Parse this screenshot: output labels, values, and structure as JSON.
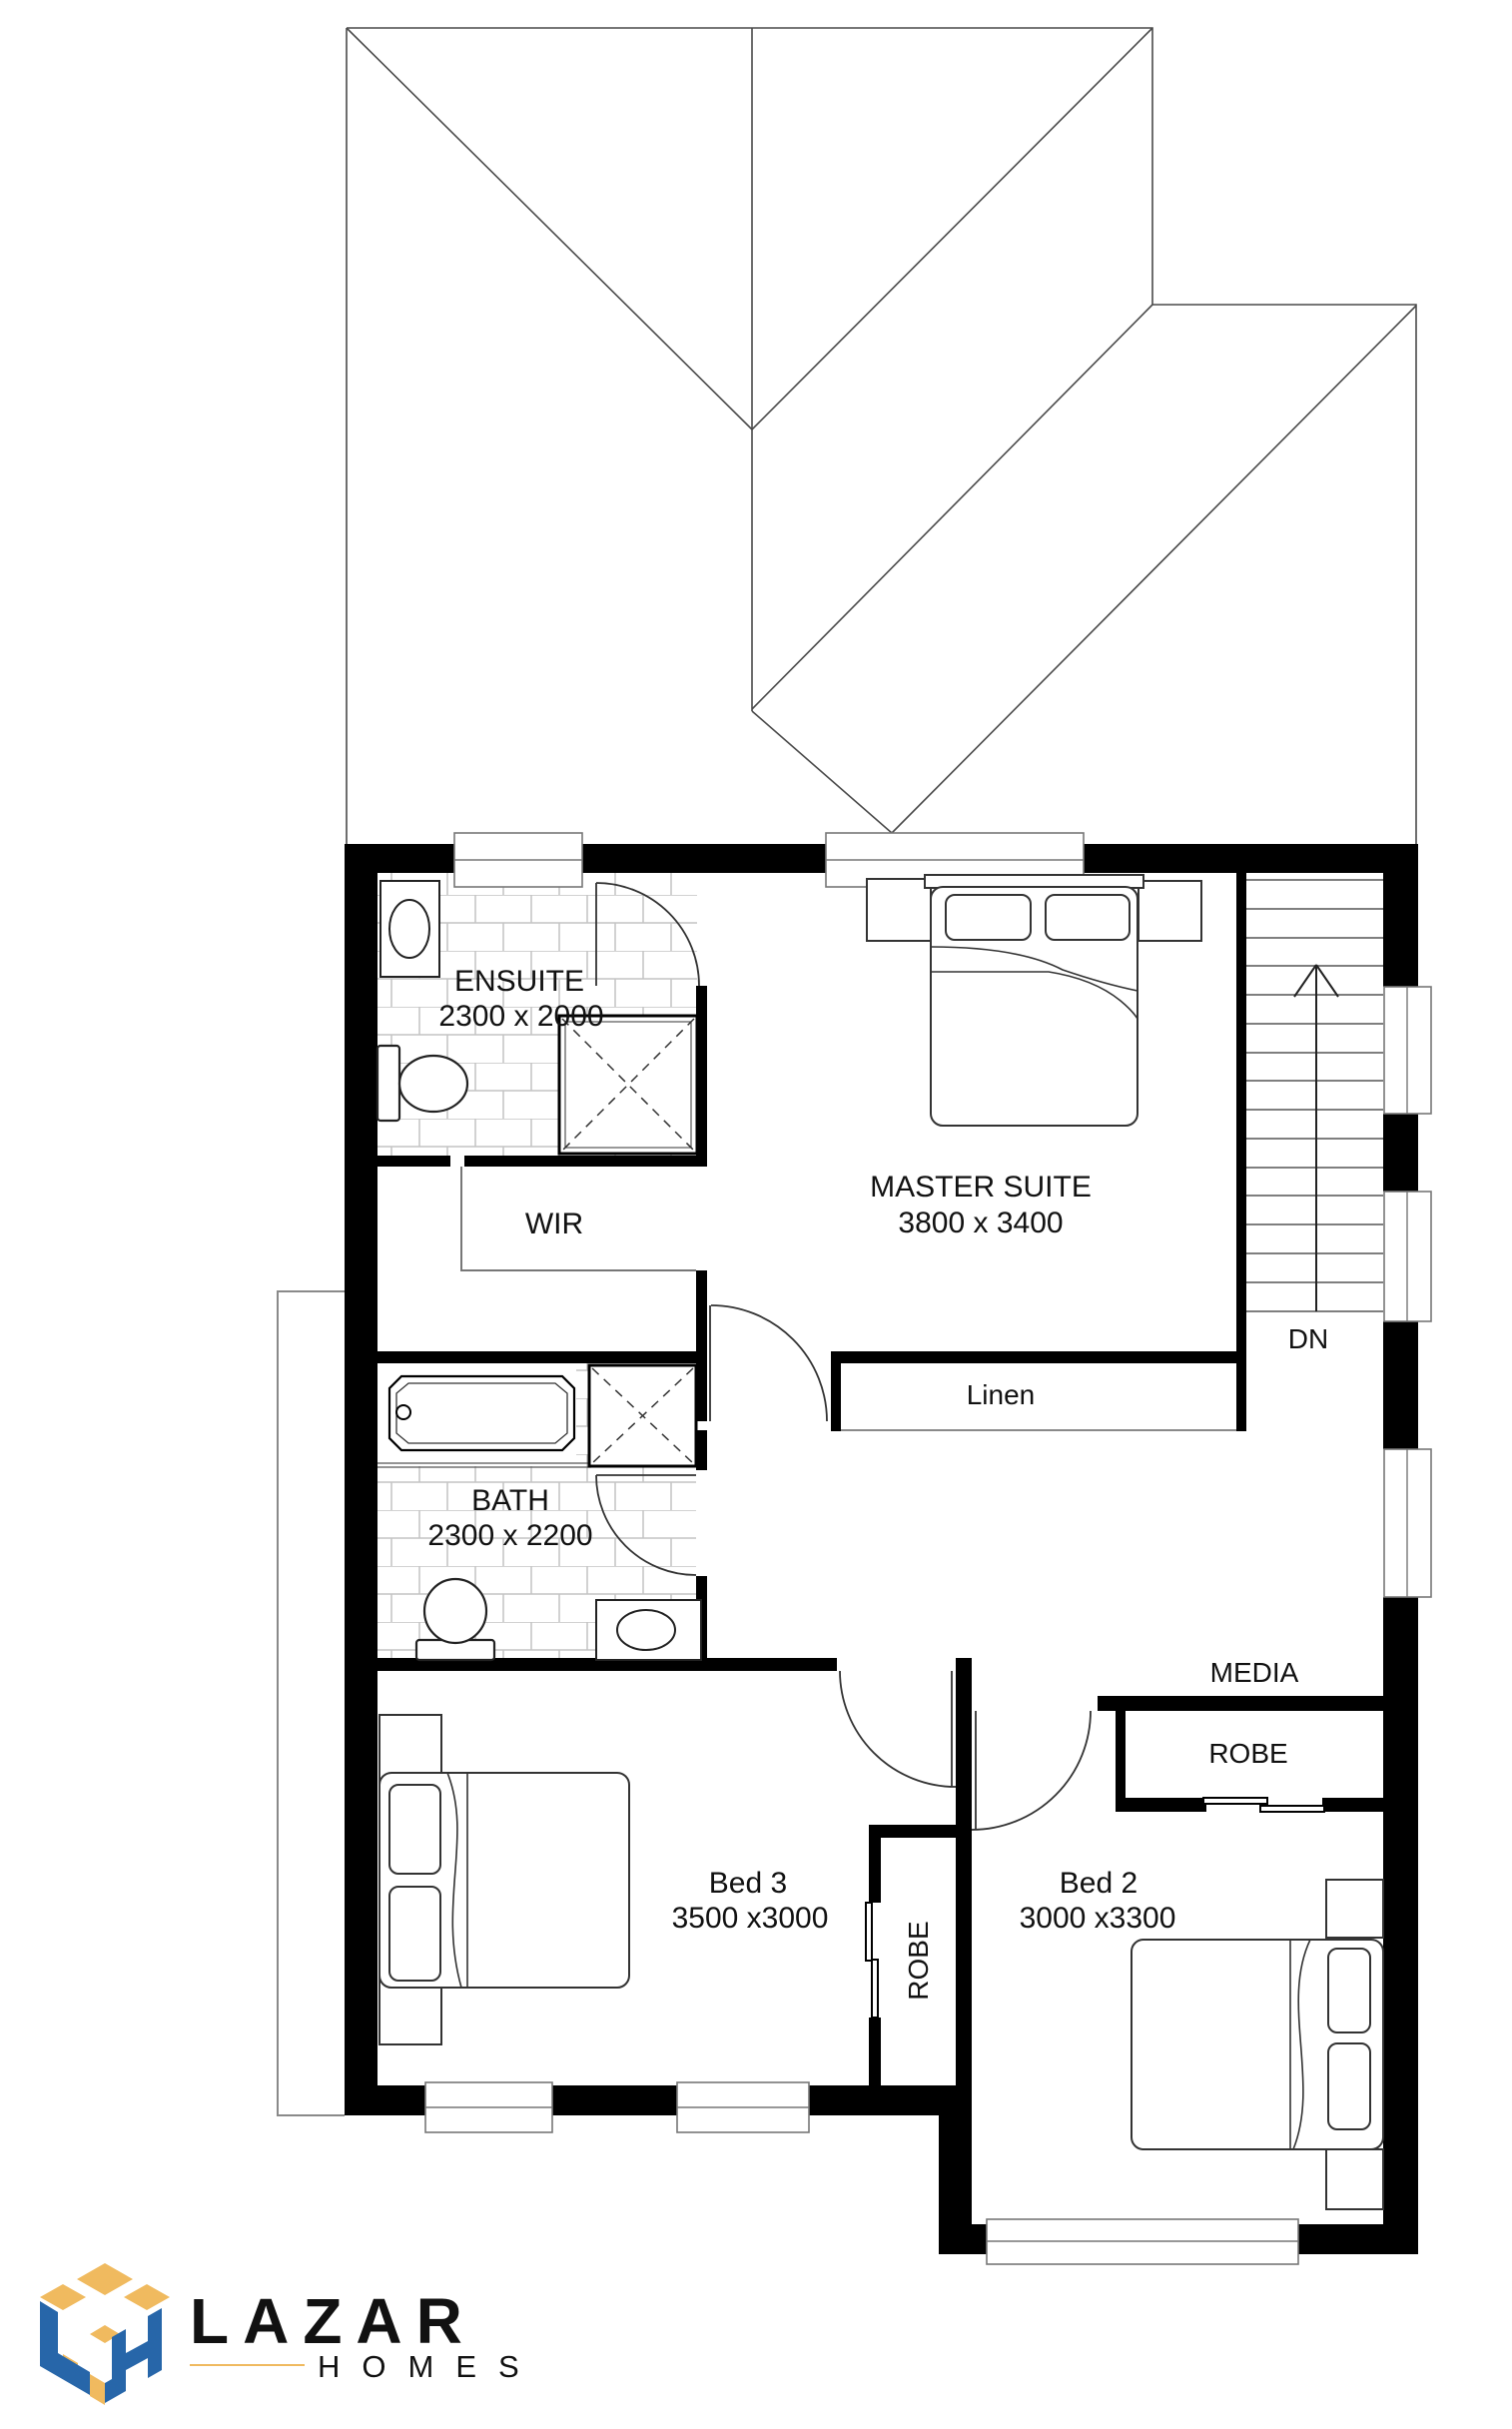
{
  "plan": {
    "rooms": {
      "ensuite": {
        "name": "ENSUITE",
        "dims": "2300 x 2000"
      },
      "master": {
        "name": "MASTER SUITE",
        "dims": "3800 x 3400"
      },
      "wir": {
        "name": "WIR"
      },
      "linen": {
        "name": "Linen"
      },
      "bath": {
        "name": "BATH",
        "dims": "2300 x 2200"
      },
      "media": {
        "name": "MEDIA"
      },
      "robe_bed2": {
        "name": "ROBE"
      },
      "robe_bed3": {
        "name": "ROBE"
      },
      "bed3": {
        "name": "Bed 3",
        "dims": "3500 x3000"
      },
      "bed2": {
        "name": "Bed 2",
        "dims": "3000 x3300"
      }
    },
    "stairs": {
      "direction_label": "DN"
    }
  },
  "logo": {
    "brand": "LAZAR",
    "sub": "HOMES",
    "colors": {
      "blue": "#2766A9",
      "gold": "#F0BA5F"
    }
  }
}
